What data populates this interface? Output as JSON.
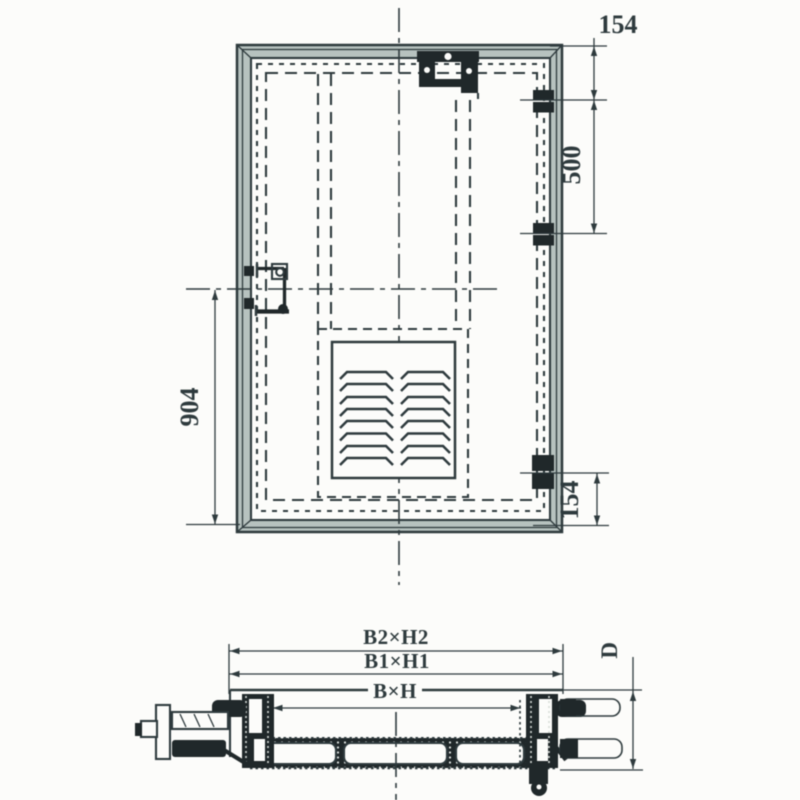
{
  "drawing_type": "door-technical-drawing",
  "front_view": {
    "dim_top_right": "154",
    "dim_right_upper": "500",
    "dim_left": "904",
    "dim_bottom_right": "154"
  },
  "section_view": {
    "dim_outer": "B2×H2",
    "dim_frame": "B1×H1",
    "dim_opening": "B×H",
    "dim_depth": "D"
  },
  "colors": {
    "ink": "#2e3a3d",
    "dark": "#20282a",
    "frame_fill": "#b7c2bf",
    "paper": "#fcfcfa"
  }
}
